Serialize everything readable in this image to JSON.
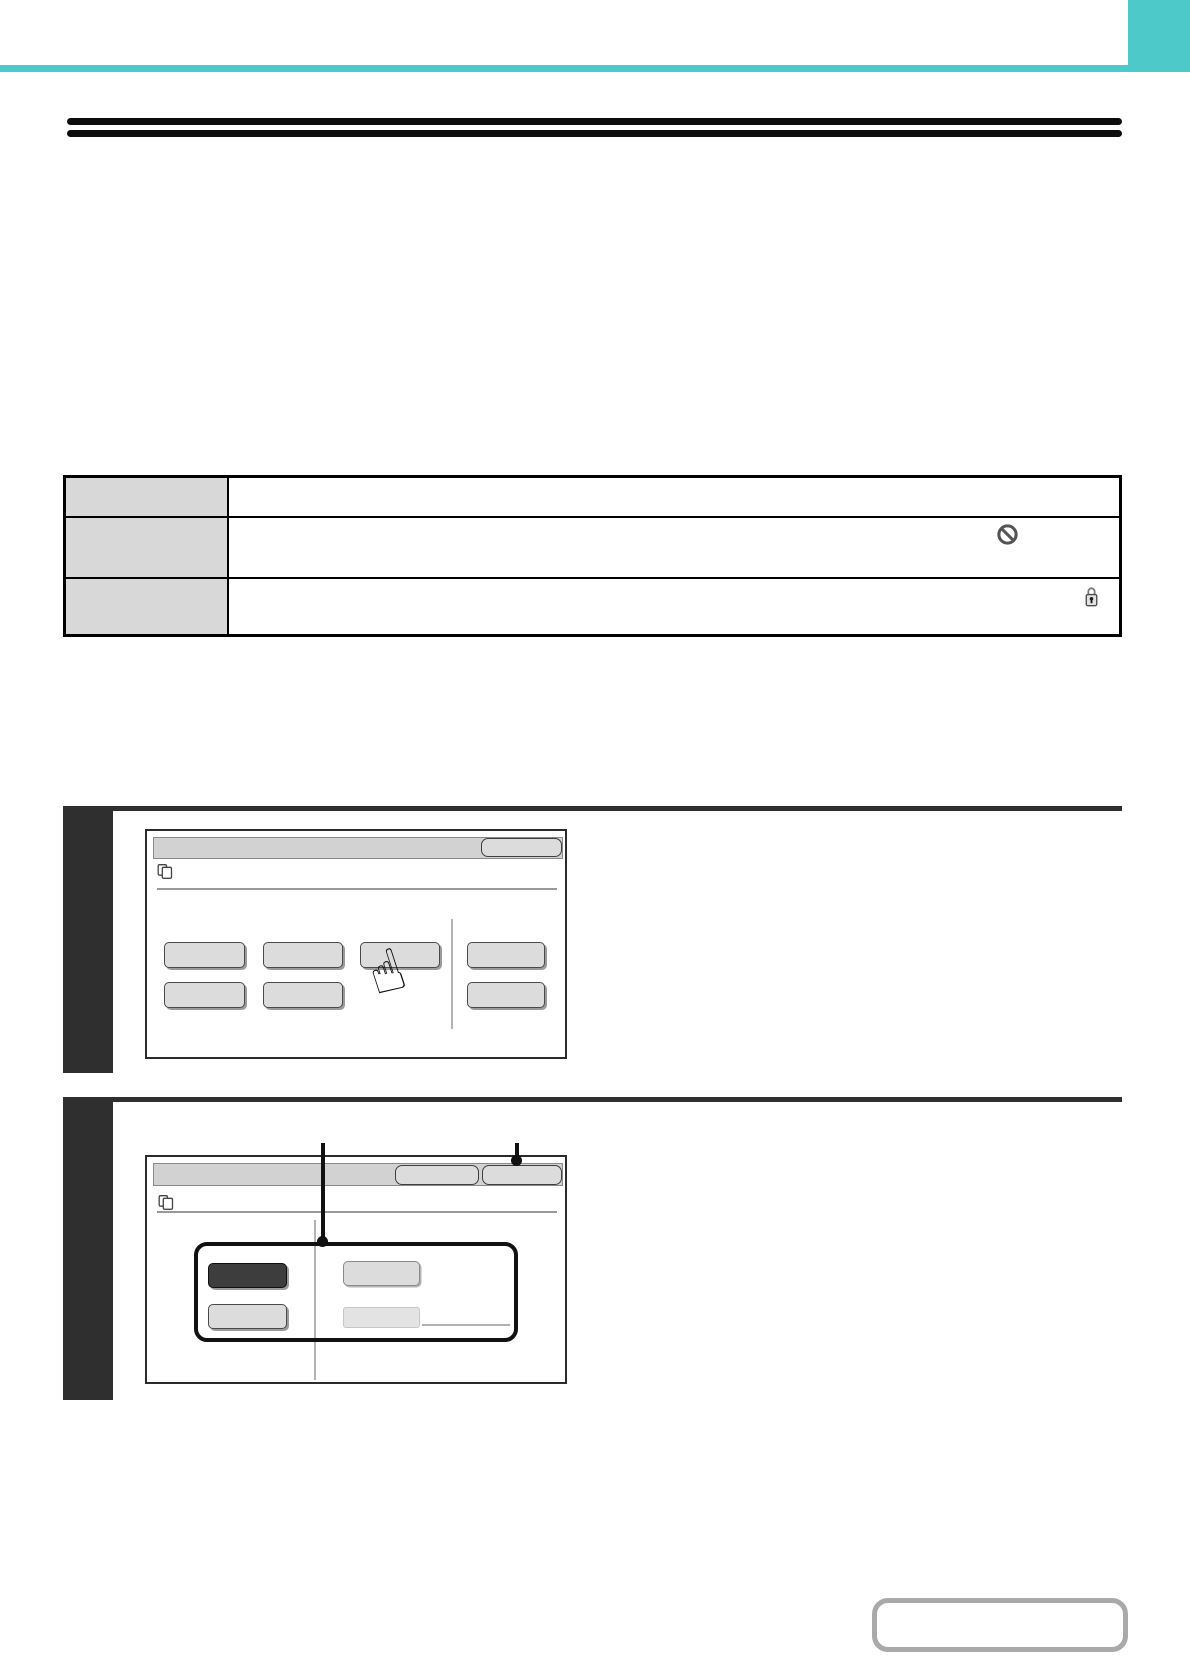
{
  "page": {
    "width": 1190,
    "height": 1656,
    "background": "#ffffff",
    "kind": "operation-manual-page",
    "text_rendered": false
  },
  "theme": {
    "page_bg": "#ffffff",
    "accent_teal": "#4dc9ca",
    "rule_black": "#0d0d0d",
    "step_dark": "#2f2f2f",
    "table_border": "#000000",
    "table_header_fill": "#d8d8d8",
    "panel_border": "#2b2b2b",
    "titlebar_fill": "#d2d2d2",
    "titlebar_border": "#8a8a8a",
    "button_fill": "#dcdcdc",
    "button_border": "#4a4a4a",
    "button_shadow": "#9b9b9b",
    "button_dark_fill": "#3d3d3d",
    "separator_gray": "#999999",
    "divider_gray": "#b3b3b3",
    "callout_black": "#111111",
    "icon_gray": "#555555",
    "nav_border": "#a9a9a9"
  },
  "header": {
    "teal_bar": {
      "x": 0,
      "y": 65,
      "width": 1190,
      "height": 7
    },
    "teal_corner_block": {
      "x": 1128,
      "y": 0,
      "width": 62,
      "height": 72
    }
  },
  "title_rule": {
    "style": "double-black-rule",
    "x": 67,
    "width": 1055,
    "line1_y": 118,
    "line2_y": 130
  },
  "info_table": {
    "x": 63,
    "y": 475,
    "width": 1059,
    "height": 162,
    "header_column_width": 163,
    "rows": [
      {
        "height": 41,
        "icon": "none"
      },
      {
        "height": 61,
        "icon": "prohibited-icon"
      },
      {
        "height": 60,
        "icon": "lock-icon"
      }
    ]
  },
  "steps": [
    {
      "index": 1,
      "screen": {
        "header_icon": "copy-pages-icon",
        "titlebar_button_count": 1,
        "key_grid": {
          "row1_keys": 4,
          "row2_keys": 3,
          "column_divider": true
        },
        "pointer": "hand-cursor-icon",
        "pointer_target": "row1-key3"
      }
    },
    {
      "index": 2,
      "screen": {
        "header_icon": "copy-pages-icon",
        "titlebar_button_count": 2,
        "callout_markers": 2,
        "callout": {
          "shape": "rounded-rect",
          "keys": 4,
          "selected_key": "top-left-dark"
        }
      }
    }
  ],
  "footer_nav": {
    "shape": "rounded-outline-button",
    "x": 872,
    "y": 1598,
    "width": 256,
    "height": 54
  }
}
